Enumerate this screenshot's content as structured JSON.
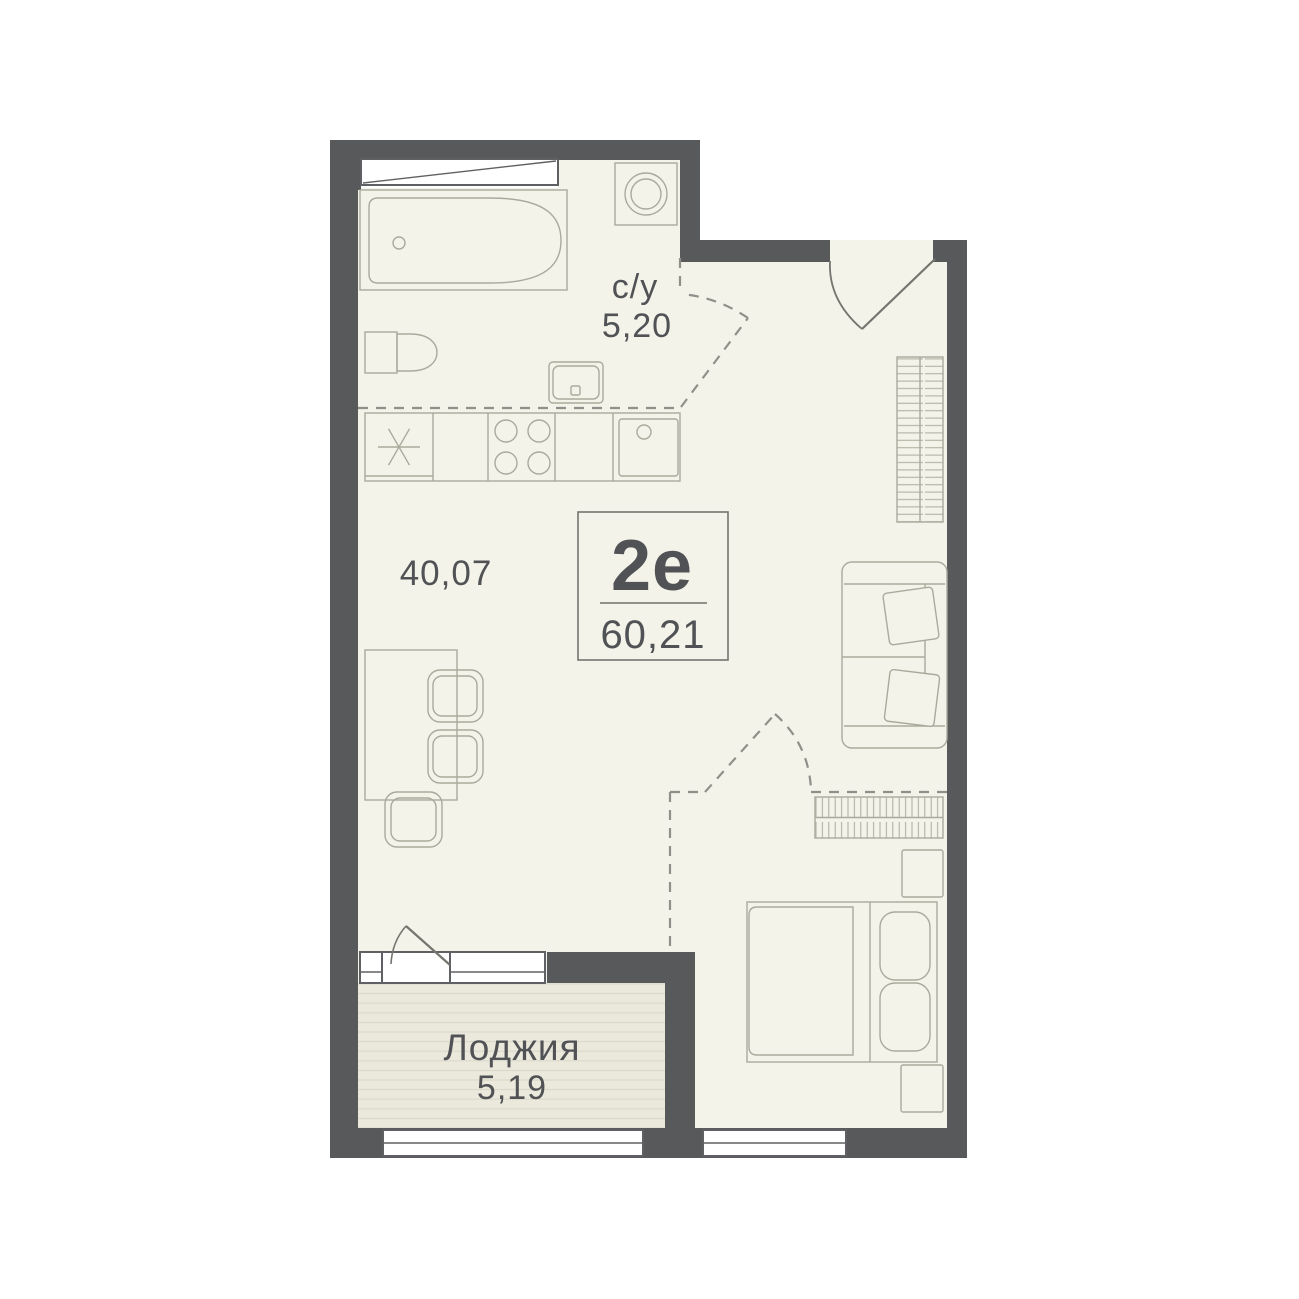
{
  "plan": {
    "type_label": "2е",
    "total_area": "60,21",
    "rooms": {
      "bathroom": {
        "name": "с/у",
        "area": "5,20"
      },
      "living": {
        "area": "40,07"
      },
      "loggia": {
        "name": "Лоджия",
        "area": "5,19"
      }
    }
  },
  "colors": {
    "background": "#ffffff",
    "wall": "#58595b",
    "floor": "#f3f3e9",
    "loggia_floor": "#eae9dc",
    "loggia_stripe": "#dbd9cb",
    "outline": "#a9aa9c",
    "dashed": "#8f9089",
    "door": "#74756f",
    "window": "#ffffff",
    "window_frame": "#5f6063",
    "box_border": "#73746e",
    "text": "#515255"
  }
}
